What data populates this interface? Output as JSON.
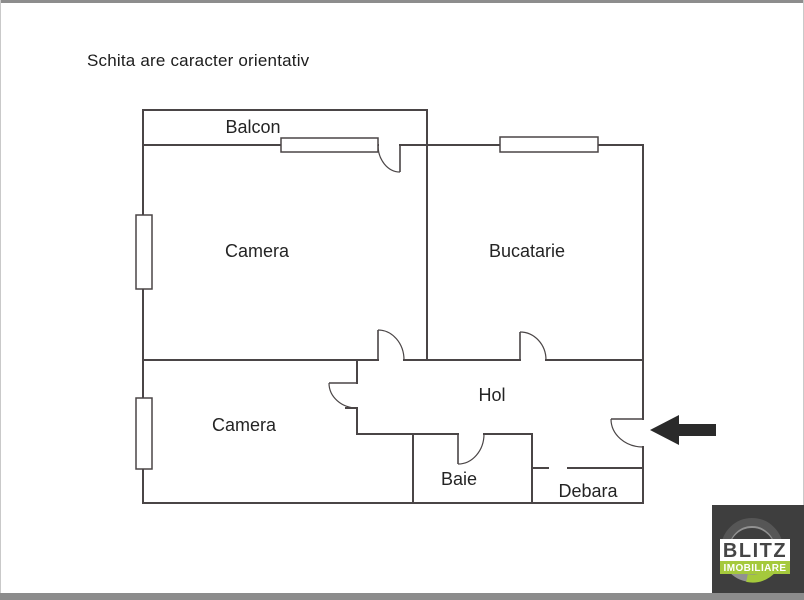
{
  "disclaimer": "Schita are caracter orientativ",
  "plan": {
    "wall_color": "#4a4546",
    "label_color": "#242424",
    "background": "#ffffff",
    "entrance_arrow_color": "#2a2a2a",
    "rooms": [
      {
        "id": "balcon",
        "label": "Balcon"
      },
      {
        "id": "camera-1",
        "label": "Camera"
      },
      {
        "id": "bucatarie",
        "label": "Bucatarie"
      },
      {
        "id": "camera-2",
        "label": "Camera"
      },
      {
        "id": "hol",
        "label": "Hol"
      },
      {
        "id": "baie",
        "label": "Baie"
      },
      {
        "id": "debara",
        "label": "Debara"
      }
    ]
  },
  "page": {
    "border_color": "#8d8d8d",
    "bottom_bar_color": "#8c8c8c"
  },
  "logo": {
    "text_primary": "BLITZ",
    "text_secondary": "IMOBILIARE",
    "background": "#3e3e3e",
    "ring_gray": "#919191",
    "ring_dark": "#565656",
    "accent_green": "#a5c93c",
    "text_primary_color": "#454545",
    "text_secondary_color": "#ffffff"
  }
}
